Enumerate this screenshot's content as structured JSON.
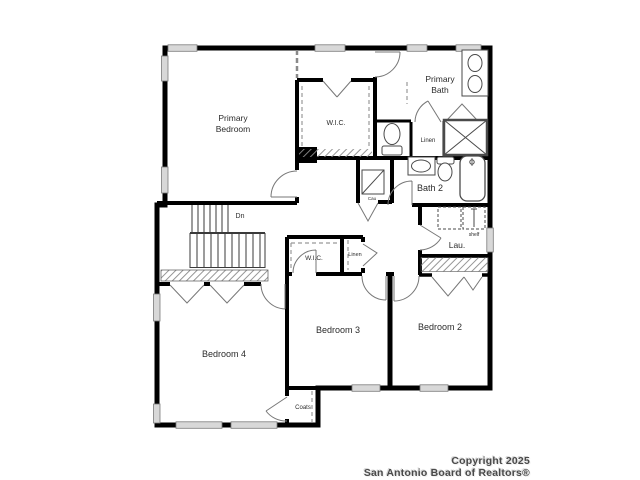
{
  "rooms": {
    "primary_bedroom_line1": "Primary",
    "primary_bedroom_line2": "Bedroom",
    "primary_bath_line1": "Primary",
    "primary_bath_line2": "Bath",
    "wic_primary": "W.I.C.",
    "linen_primary": "Linen",
    "bath2": "Bath 2",
    "laundry": "Lau.",
    "laundry_shelf": "shelf",
    "wic_bedroom3": "W.I.C.",
    "linen_hall": "Linen",
    "bedroom2": "Bedroom 2",
    "bedroom3": "Bedroom 3",
    "bedroom4": "Bedroom 4",
    "coats": "Coats",
    "stairs_direction": "Dn",
    "utility_closet": "Cau"
  },
  "footer": {
    "line1": "Copyright 2025",
    "line2": "San Antonio Board of Realtors®"
  },
  "colors": {
    "wall": "#000000",
    "fixture": "#4a4a4a",
    "door": "#777777",
    "window_fill": "#d8d8d8",
    "label": "#2b2b2b",
    "footer_text": "#4a4a4a",
    "background": "#ffffff"
  }
}
